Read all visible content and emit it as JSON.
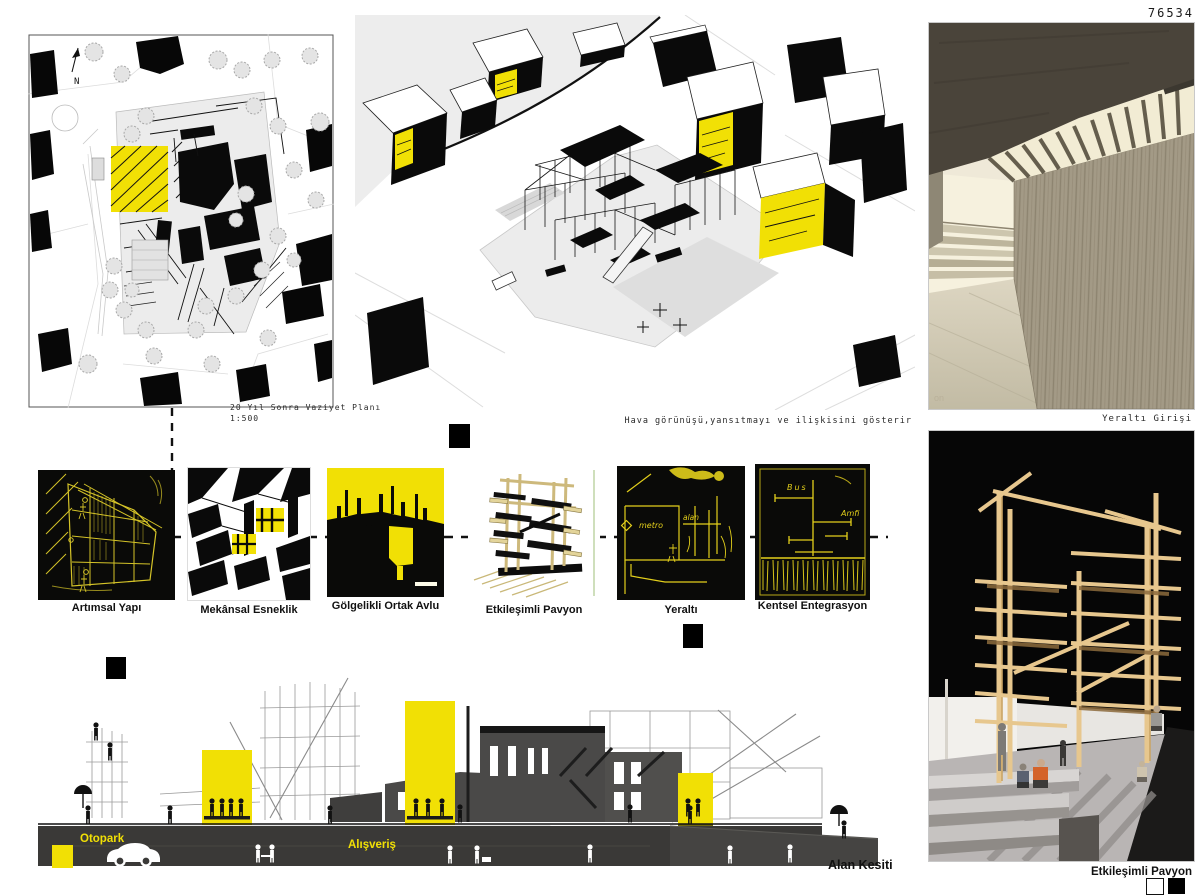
{
  "code": "76534",
  "site_plan": {
    "caption": "20 Yıl Sonra Vaziyet Planı",
    "scale": "1:500",
    "north": "N"
  },
  "axon": {
    "caption": "Hava görünüşü,yansıtmayı ve ilişkisini gösterir"
  },
  "photos": {
    "underground_caption": "Yeraltı Girişi",
    "underground_watermark": "on",
    "pavilion_caption": "Etkileşimli Pavyon"
  },
  "diagrams": [
    {
      "label": "Artımsal Yapı"
    },
    {
      "label": "Mekânsal Esneklik"
    },
    {
      "label": "Gölgelikli Ortak Avlu"
    },
    {
      "label": "Etkileşimli Pavyon"
    },
    {
      "label": "Yeraltı"
    },
    {
      "label": "Kentsel Entegrasyon"
    }
  ],
  "sketch_annotations": {
    "metro": "metro",
    "alan": "alan",
    "bus": "Bus",
    "amfi": "Amfi"
  },
  "section": {
    "caption": "Alan Kesiti",
    "otopark": "Otopark",
    "alisveris": "Alışveriş"
  },
  "colors": {
    "accent_yellow": "#F1E005",
    "ink_black": "#000000",
    "underground_gray": "#3A3937",
    "section_mass_gray": "#4A4948"
  }
}
